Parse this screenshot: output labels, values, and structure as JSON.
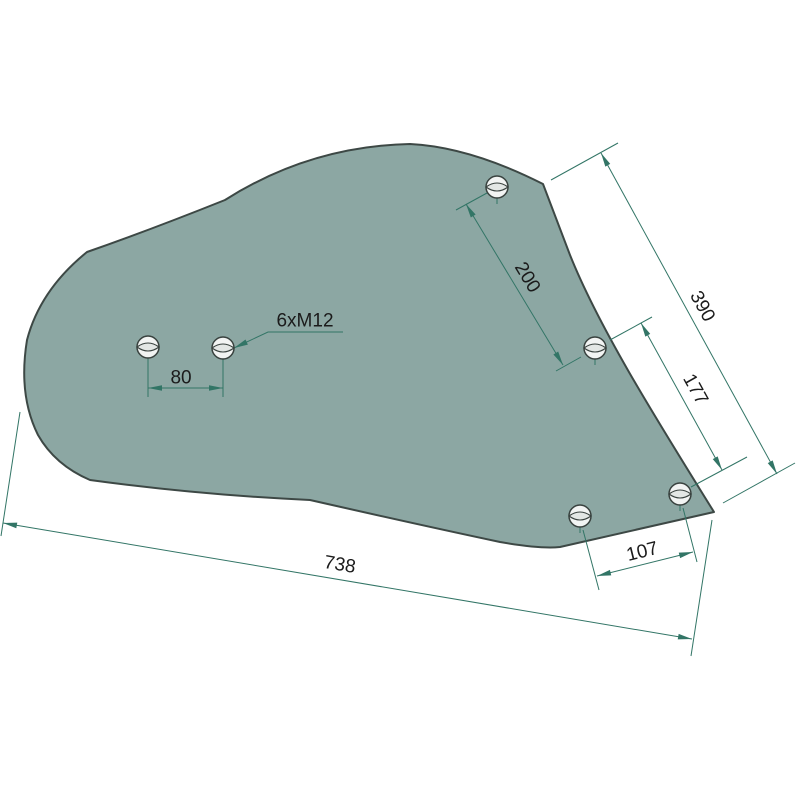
{
  "drawing": {
    "background": "#ffffff",
    "part": {
      "name": "mouldboard-plate",
      "fill": "#8CA7A3",
      "stroke": "#3D4845",
      "stroke_width": 2,
      "outline_path": "M 543,184 Q 470,147 410,144 Q 310,146 225,200 Q 150,230 87,252 Q 40,290 27,340 Q 18,395 38,435 Q 55,465 90,480 Q 200,495 310,500 Q 420,525 500,542 Q 540,549 560,547 L 714,512 C 660,425 600,330 570,255 Q 553,210 543,184 Z"
    },
    "holes": {
      "radius": 11,
      "fill": "#F2F4F3",
      "lens_fill": "#E3E7E5",
      "stroke": "#39423F",
      "centers": [
        [
          148,
          347
        ],
        [
          223,
          348
        ],
        [
          497,
          187
        ],
        [
          595,
          348
        ],
        [
          580,
          516
        ],
        [
          680,
          494
        ]
      ]
    },
    "dimension_style": {
      "color": "#327566",
      "text_color": "#1B1B1B",
      "font_size": 19,
      "arrow_len": 14,
      "arrow_half_w": 2.8
    },
    "dimensions": [
      {
        "label": "80",
        "value": 80,
        "line": [
          148,
          388,
          223,
          388
        ],
        "ext": [
          [
            148,
            358,
            148,
            397
          ],
          [
            223,
            359,
            223,
            397
          ]
        ],
        "label_pos": [
          181,
          377,
          0
        ],
        "arrows": [
          [
            148,
            388,
            180
          ],
          [
            223,
            388,
            0
          ]
        ]
      },
      {
        "label": "200",
        "value": 200,
        "line": [
          466,
          204,
          563,
          365
        ],
        "ext": [
          [
            456,
            210,
            487,
            193
          ],
          [
            556,
            371,
            581,
            357
          ]
        ],
        "label_pos": [
          528,
          277,
          59
        ],
        "arrows": [
          [
            466,
            204,
            239
          ],
          [
            563,
            365,
            59
          ]
        ]
      },
      {
        "label": "177",
        "value": 177,
        "line": [
          641,
          323,
          722,
          470
        ],
        "ext": [
          [
            610,
            340,
            652,
            317
          ],
          [
            691,
            487,
            747,
            457
          ]
        ],
        "label_pos": [
          696,
          389,
          61
        ],
        "arrows": [
          [
            641,
            323,
            241
          ],
          [
            722,
            470,
            61
          ]
        ]
      },
      {
        "label": "390",
        "value": 390,
        "line": [
          601,
          153,
          777,
          474
        ],
        "ext": [
          [
            551,
            180,
            618,
            143
          ],
          [
            723,
            503,
            795,
            463
          ]
        ],
        "label_pos": [
          703,
          306,
          61
        ],
        "arrows": [
          [
            601,
            153,
            241
          ],
          [
            777,
            474,
            61
          ]
        ]
      },
      {
        "label": "107",
        "value": 107,
        "line": [
          597,
          576,
          693,
          552
        ],
        "ext": [
          [
            583,
            530,
            599,
            590
          ],
          [
            683,
            508,
            697,
            562
          ]
        ],
        "label_pos": [
          642,
          551,
          -14
        ],
        "arrows": [
          [
            597,
            576,
            166
          ],
          [
            693,
            552,
            -14
          ]
        ]
      },
      {
        "label": "738",
        "value": 738,
        "line": [
          3,
          523,
          692,
          639
        ],
        "ext": [
          [
            20,
            412,
            1,
            536
          ],
          [
            712,
            520,
            691,
            656
          ]
        ],
        "label_pos": [
          340,
          564,
          9.6
        ],
        "arrows": [
          [
            3,
            523,
            190
          ],
          [
            692,
            639,
            9.6
          ]
        ]
      }
    ],
    "leader": {
      "label": "6xM12",
      "points": "343,332 268,332 234,348",
      "arrow": [
        234,
        348,
        155
      ],
      "label_pos": [
        305,
        320,
        0
      ]
    }
  }
}
